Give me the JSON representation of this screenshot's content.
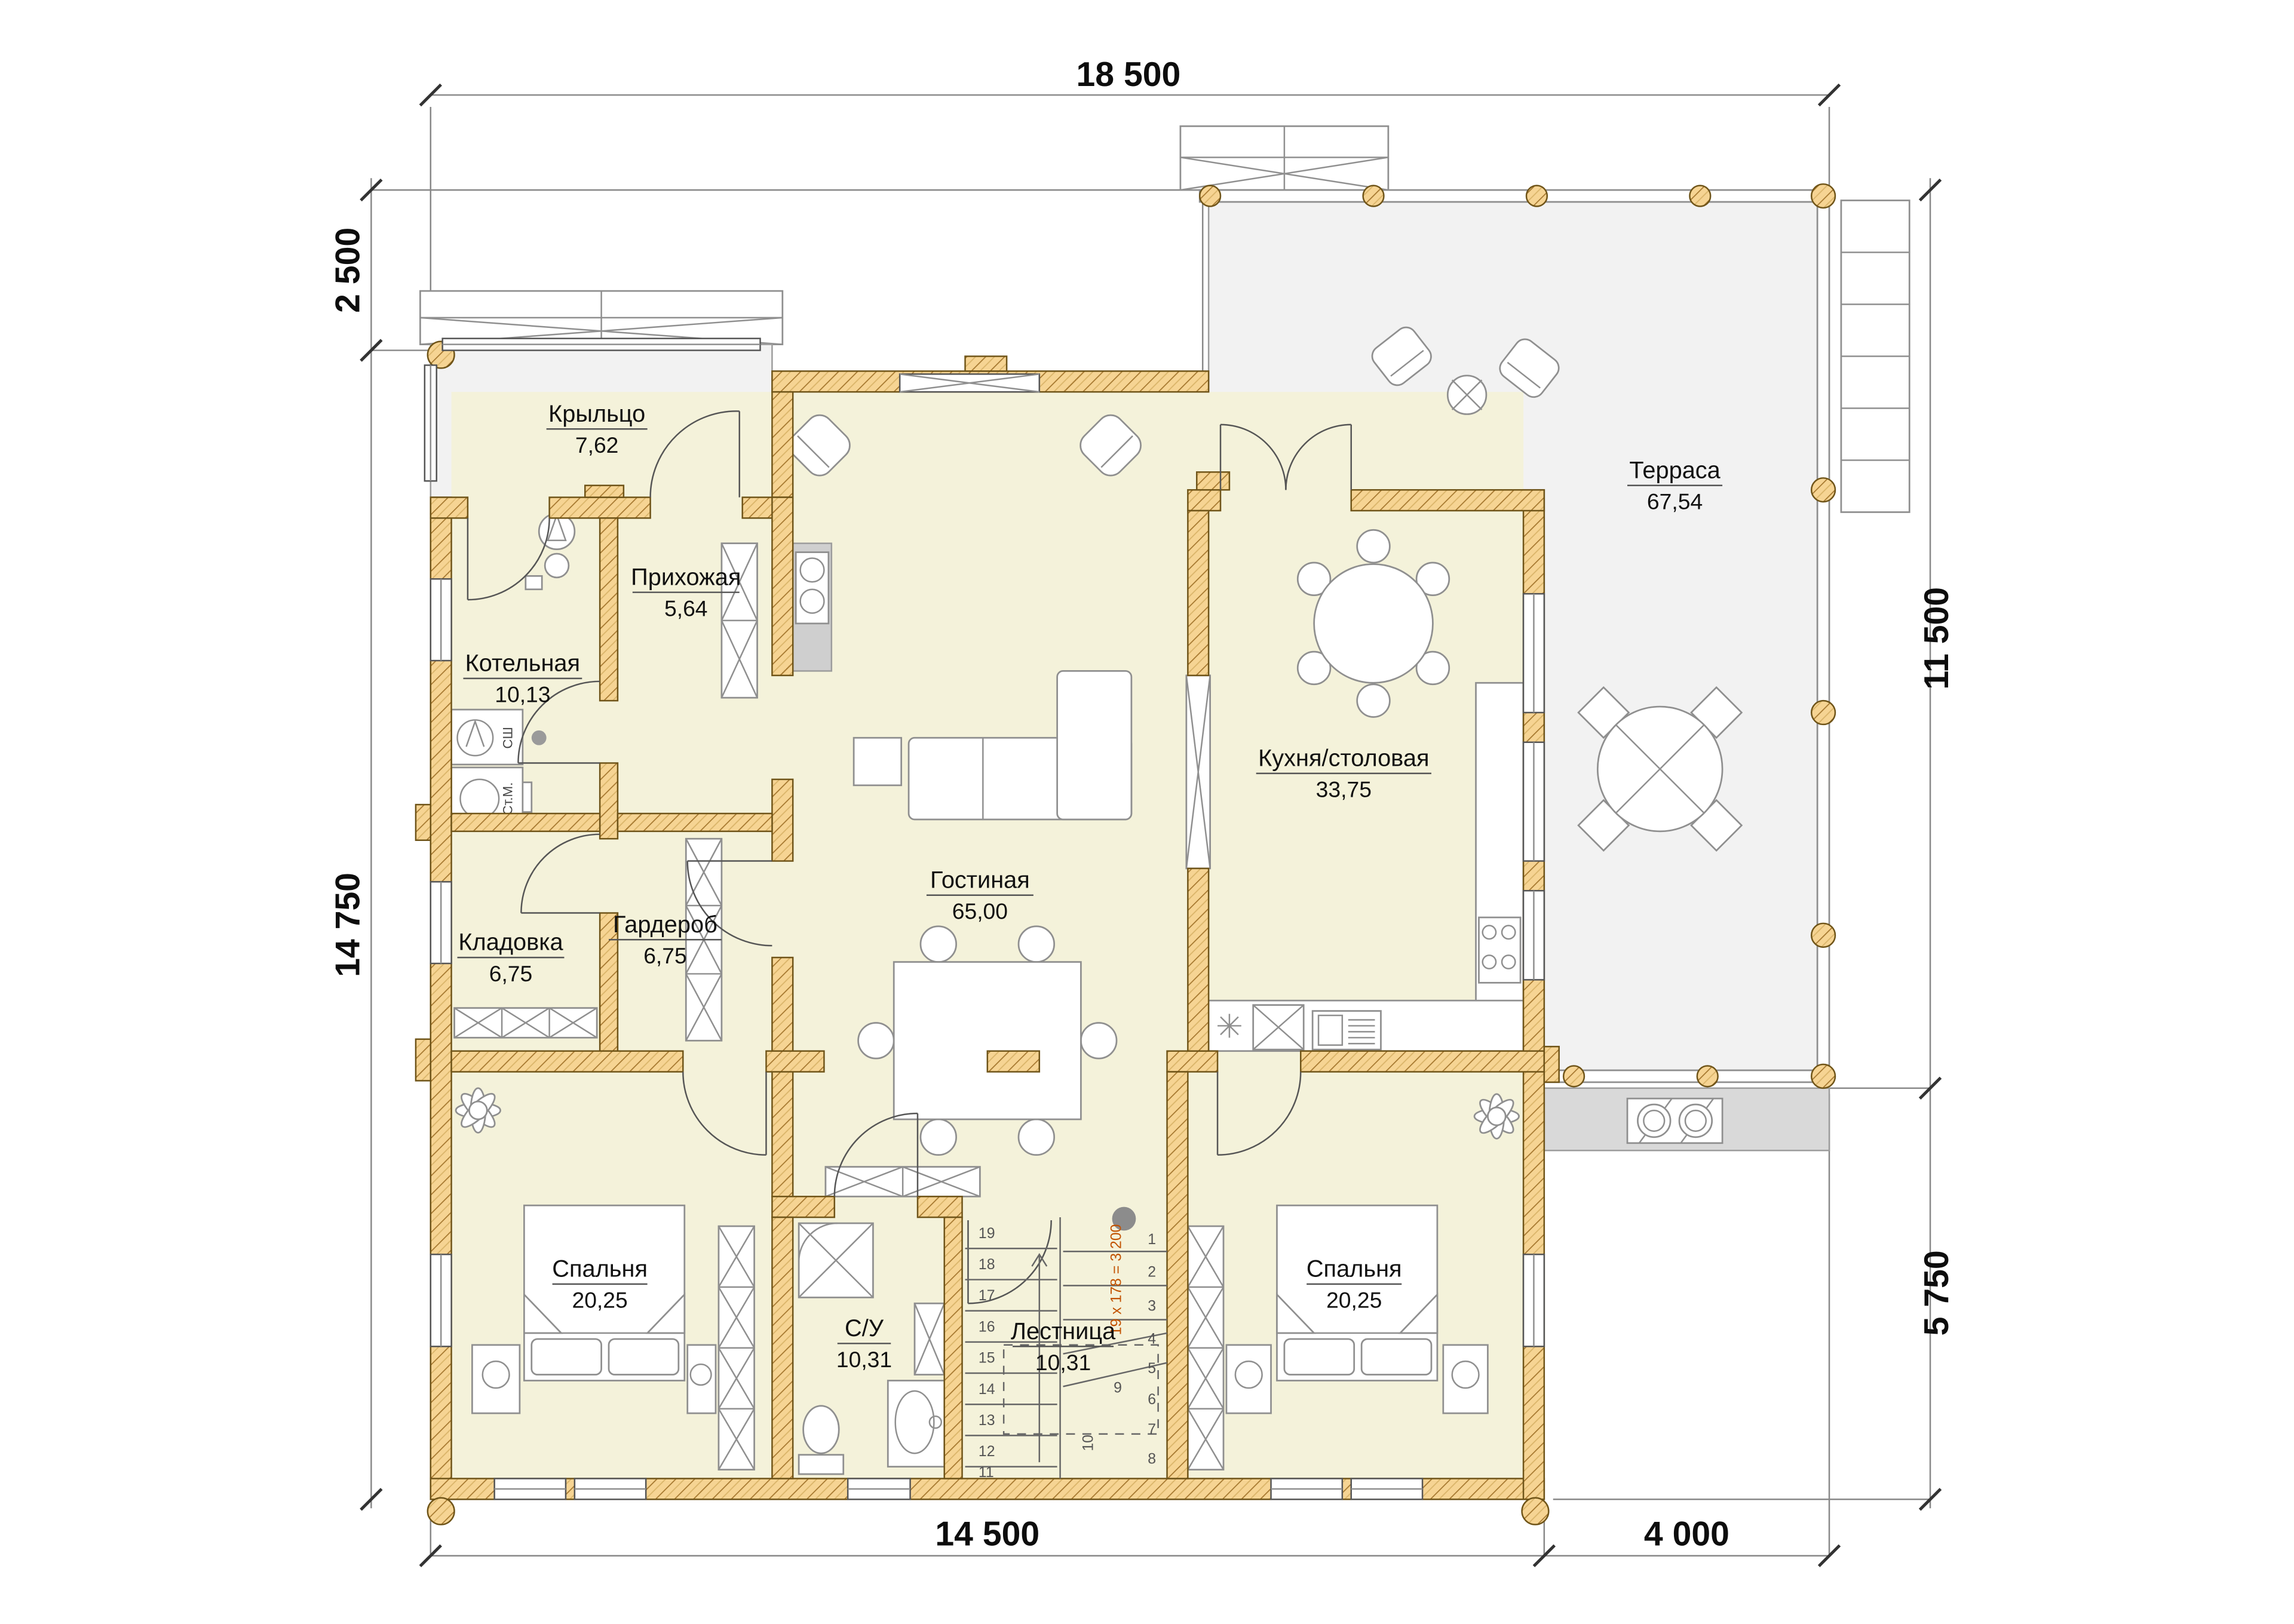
{
  "dimensions": {
    "top": "18 500",
    "left_upper": "2 500",
    "left_lower": "14 750",
    "right_upper": "11 500",
    "right_lower": "5 750",
    "bottom_left": "14 500",
    "bottom_right": "4 000"
  },
  "rooms": {
    "porch": {
      "name": "Крыльцо",
      "area": "7,62"
    },
    "hallway": {
      "name": "Прихожая",
      "area": "5,64"
    },
    "boiler": {
      "name": "Котельная",
      "area": "10,13"
    },
    "storage": {
      "name": "Кладовка",
      "area": "6,75"
    },
    "wardrobe": {
      "name": "Гардероб",
      "area": "6,75"
    },
    "living": {
      "name": "Гостиная",
      "area": "65,00"
    },
    "kitchen": {
      "name": "Кухня/столовая",
      "area": "33,75"
    },
    "terrace": {
      "name": "Терраса",
      "area": "67,54"
    },
    "bedroom_left": {
      "name": "Спальня",
      "area": "20,25"
    },
    "bedroom_right": {
      "name": "Спальня",
      "area": "20,25"
    },
    "bathroom": {
      "name": "С/У",
      "area": "10,31"
    },
    "stairs": {
      "name": "Лестница",
      "area": "10,31"
    }
  },
  "stairs": {
    "annotation": "19 x 178 = 3 200",
    "numbers_left": [
      "19",
      "18",
      "17",
      "16",
      "15",
      "14",
      "13",
      "12",
      "11"
    ],
    "numbers_right": [
      "1",
      "2",
      "3",
      "4",
      "5",
      "6",
      "7",
      "8",
      "9"
    ],
    "number_mid": "10"
  },
  "appliances": {
    "dryer": "СШ",
    "washer": "Ст.М."
  },
  "colors": {
    "wall_fill": "#f6d493",
    "wall_hatch": "#a5772e",
    "room_fill": "#f4f2da",
    "outdoor_fill": "#f2f2f2",
    "stair_note": "#c25200"
  }
}
